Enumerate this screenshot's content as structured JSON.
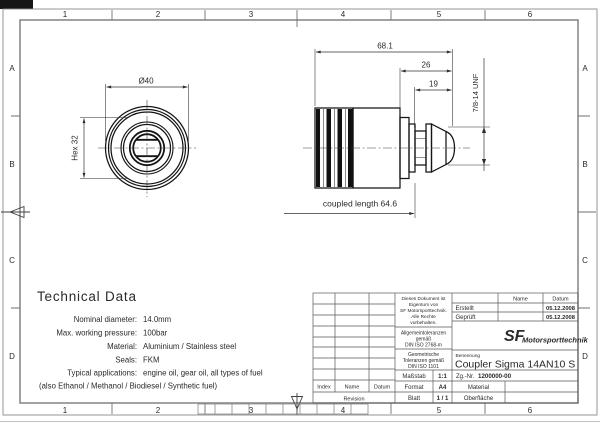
{
  "sheet": {
    "grid_cols": [
      "1",
      "2",
      "3",
      "4",
      "5",
      "6"
    ],
    "grid_rows": [
      "A",
      "B",
      "C",
      "D"
    ]
  },
  "front_view": {
    "diameter_label": "Ø40",
    "hex_label": "Hex 32"
  },
  "side_view": {
    "overall_length": "68.1",
    "step_length": "26",
    "thread_length": "19",
    "thread_spec": "7/8-14 UNF",
    "coupled_length": "coupled length 64.6"
  },
  "technical_data": {
    "title": "Technical Data",
    "rows": [
      {
        "label": "Nominal diameter:",
        "value": "14.0mm"
      },
      {
        "label": "Max. working pressure:",
        "value": "100bar"
      },
      {
        "label": "Material:",
        "value": "Aluminium / Stainless steel"
      },
      {
        "label": "Seals:",
        "value": "FKM"
      },
      {
        "label": "Typical applications:",
        "value": "engine oil, gear oil, all types of fuel"
      }
    ],
    "note": "(also Ethanol / Methanol / Biodiesel / Synthetic fuel)"
  },
  "title_block": {
    "ownership_lines": [
      "Dieses Dokument ist",
      "Eigentum von",
      "SF Motorsporttechnik.",
      "Alle Rechte",
      "vorbehalten."
    ],
    "tol_general_lines": [
      "Allgemeintoleranzen",
      "gemäß",
      "DIN ISO 2768-m"
    ],
    "tol_geometric_lines": [
      "Geometrische",
      "Toleranzen gemäß",
      "DIN ISO 1101"
    ],
    "scale_label": "Maßstab",
    "scale_value": "1:1",
    "format_label": "Format",
    "format_value": "A4",
    "sheet_label": "Blatt",
    "sheet_value": "1 / 1",
    "name_header": "Name",
    "date_header": "Datum",
    "created_label": "Erstellt",
    "created_date": "05.12.2008",
    "checked_label": "Geprüft",
    "checked_date": "05.12.2008",
    "logo_sf": "SF",
    "logo_name": "Motorsporttechnik",
    "designation_label": "Benennung",
    "designation": "Coupler Sigma 14AN10 S",
    "drawing_no_label": "Zg.-Nr.",
    "drawing_no": "1200000-00",
    "material_label": "Material",
    "surface_label": "Oberfläche",
    "revision": {
      "index": "Index",
      "name": "Name",
      "date": "Datum",
      "revision": "Revision"
    }
  }
}
